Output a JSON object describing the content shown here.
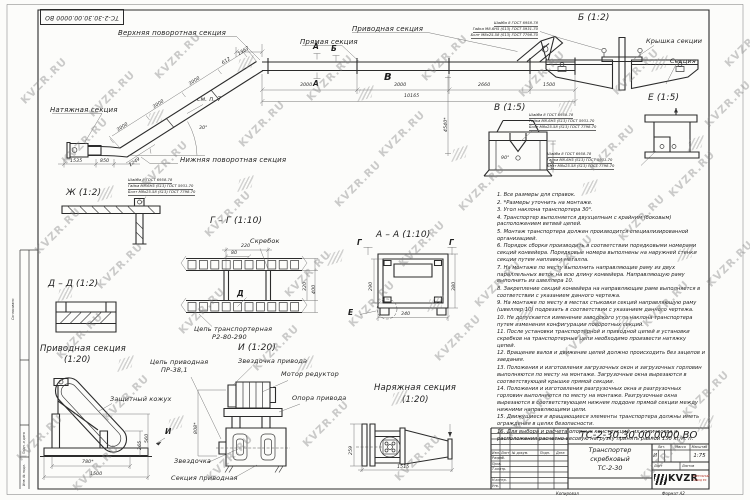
{
  "watermark": {
    "text": "KVZR.RU"
  },
  "frame": {
    "stamp_number": "ТС-2-30.30.00.0000 ВО",
    "left_soglasovano": "Согласовано",
    "left_podp_data": "Подп. и дата",
    "left_inv_podl": "Инв. № подл.",
    "kopiroval": "Копировал",
    "format": "Формат А2"
  },
  "main_view": {
    "labels": {
      "upper_turn": "Верхняя поворотная секция",
      "straight": "Прямая секция",
      "drive": "Приводная секция",
      "tension": "Натяжная секция",
      "lower_turn": "Нижняя поворотная секция",
      "see_note": "см. п. 7"
    },
    "markers": {
      "a": "А",
      "b": "Б",
      "v": "В"
    },
    "dims": {
      "d1367": "1367",
      "d3000": "3000",
      "d2660": "2660",
      "d1500": "1500",
      "d10165": "10165",
      "d612": "612",
      "d1535": "1535",
      "d850": "850",
      "d1249": "1249",
      "angle": "30°",
      "d4540": "4540*"
    }
  },
  "hw": {
    "l1": "Шайба 8 ГОСТ 6958-78",
    "l2": "Гайка М8-6Н5 (S13) ГОСТ 5931-70",
    "l3": "Болт М8х25.58 (S13) ГОСТ 7798-70"
  },
  "views": {
    "b": {
      "title": "Б (1:2)",
      "cover": "Крышка секции",
      "section": "Секция"
    },
    "v": {
      "title": "В (1:5)",
      "angle": "90°",
      "dim454": "454"
    },
    "e": {
      "title": "Е (1:5)"
    },
    "zh": {
      "title": "Ж (1:2)"
    },
    "gg": {
      "title": "Г – Г (1:10)",
      "scraper": "Скребок",
      "chain_l1": "Цепь транспортерная",
      "chain_l2": "Р2-80-290",
      "d220": "220",
      "d80": "80",
      "d320": "320",
      "d400": "400",
      "marker_d": "Д"
    },
    "aa": {
      "title": "А – А (1:10)",
      "marker_g": "Г",
      "marker_e": "Е",
      "d290": "290",
      "d380": "380",
      "d340": "340"
    },
    "dd": {
      "title": "Д – Д (1:2)"
    },
    "drive": {
      "title": "Приводная секция",
      "scale": "(1:20)",
      "cover": "Защитный кожух",
      "sprocket": "Звездочка",
      "caption": "Секция приводная",
      "marker_i": "И",
      "d560": "560",
      "d265": "265",
      "d780": "780*",
      "d1500": "1500"
    },
    "i": {
      "title": "И (1:20)",
      "chain_l1": "Цепь приводная",
      "chain_l2": "ПР-38,1",
      "sprocket": "Звездочка привода",
      "motor": "Мотор редуктор",
      "support": "Опора привода",
      "d808": "808*"
    },
    "tension": {
      "title": "Наряжная секция",
      "scale": "(1:20)",
      "d259": "259",
      "d1515": "1515"
    }
  },
  "notes": {
    "items": [
      "1. Все размеры для справок.",
      "2. *Размеры уточнить на монтаже.",
      "3. Угол наклона транспортера 30°.",
      "4. Транспортер выполняется двухцепным с крайним (боковым) расположением ветвей цепей.",
      "5. Монтаж транспортера должен производится специализированной организацией.",
      "6. Порядок сборки производить в соответствии порядковыми номерами секций конвейера. Порядковые номера выполнены на наружней стенки секции путем наплавки металла.",
      "7. На монтаже по месту выполнить направляющие раму из двух параллельных веток на всю длину конвейера. Направляющую раму выполнить из швеллера 10.",
      "8. Закрепление секций конвейера на направляющие раме выполняется в соответствии с указанием данного чертежа.",
      "9. На монтаже по месту в местах стыковки секций направляющую раму (швеллер 10) подрезать в соответствии с указанием данного чертежа.",
      "10. Не допускается изменение заводского угла наклона транспортера путем изменения конфигурации поворотных секций.",
      "11. После установки транспортерной и приводной цепей и установки скребков на транспортерные цепи необходимо произвести натяжку цепей.",
      "12. Вращение валов и движение цепей должно происходить без зацепов и заедания.",
      "13. Положения и изготовления загрузочных окон и загрузочных горловин выполняются по месту на монтаже. Загрузочные окна вырезаются в соответствующей крышке прямой секции.",
      "14. Положения и изготовления разгрузочных окна и разгрузочных горловин выполняются по месту на монтаже. Разгрузочные окна вырезаются в соответствующем нижнем поддоне прямой секции между нижними направляющими цепи.",
      "15. Движущиеся и вращающиеся элементы транспортера должны иметь ограждения в целях безопасности.",
      "16. Для выбора и расчета опорных конструкций, их количества и расположения расчетно-весовую нагрузку принять равной 150 кг/м. п."
    ]
  },
  "title_block": {
    "doc_number": "ТС-2-30.30.00.0000 ВО",
    "product_l1": "Транспортер",
    "product_l2": "скребковый",
    "product_l3": "ТС-2-30",
    "lit_header": "Лит.",
    "mass_header": "Масса",
    "scale_header": "Масштаб",
    "lit_value": "И",
    "scale_value": "1:75",
    "sheet_label": "Лист",
    "sheets_label": "Листов",
    "col_izm": "Изм.",
    "col_list": "Лист",
    "col_ndoc": "№ докум.",
    "col_podp": "Подп.",
    "col_data": "Дата",
    "row_razrab": "Разраб.",
    "row_prov": "Пров.",
    "row_tkontr": "Т.контр.",
    "row_nkontr": "Н.контр.",
    "row_utv": "Утв.",
    "logo_text": "KVZR",
    "logo_sub1": "КОТЕЛЬНЫЙ",
    "logo_sub2": "ЗАВОД РФ",
    "accent_red": "#b23327",
    "line_color": "#2b2b2b"
  }
}
